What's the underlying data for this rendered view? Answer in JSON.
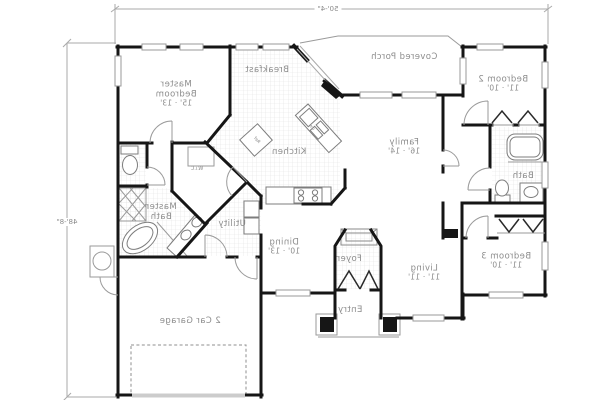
{
  "plan": {
    "overall_dimensions": {
      "width_label": "50'-4\"",
      "height_label": "48'-8\""
    },
    "rooms": {
      "master_bedroom": {
        "name": "Master Bedroom",
        "dims": "15' · 13'"
      },
      "breakfast": {
        "name": "Breakfast"
      },
      "covered_porch": {
        "name": "Covered Porch"
      },
      "bedroom_2": {
        "name": "Bedroom 2",
        "dims": "11' · 10'"
      },
      "kitchen": {
        "name": "Kitchen"
      },
      "family": {
        "name": "Family",
        "dims": "16' · 14'"
      },
      "bath": {
        "name": "Bath"
      },
      "wic": {
        "name": "W.i.C"
      },
      "master_bath": {
        "name": "Master Bath"
      },
      "utility": {
        "name": "Utility"
      },
      "dining": {
        "name": "Dining",
        "dims": "10' · 13'"
      },
      "foyer": {
        "name": "Foyer"
      },
      "living": {
        "name": "Living",
        "dims": "11' · 11'"
      },
      "bedroom_3": {
        "name": "Bedroom 3",
        "dims": "11' · 10'"
      },
      "entry": {
        "name": "Entry"
      },
      "garage": {
        "name": "2 Car Garage"
      }
    },
    "appliances": {
      "dishwasher": "dw",
      "refrigerator": "Ref"
    },
    "colors": {
      "walls": "#161616",
      "text": "#8c8c8c",
      "tile_line": "#dedede",
      "dimension": "#9a9a9a"
    },
    "notes": {
      "text_orientation": "mirrored"
    }
  }
}
